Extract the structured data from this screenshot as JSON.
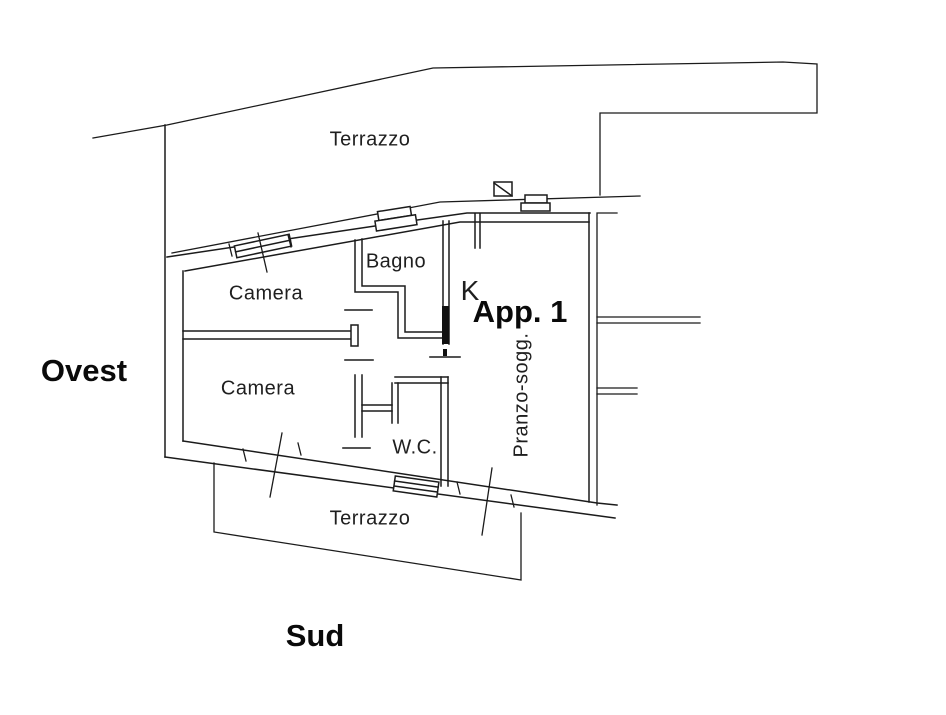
{
  "plan": {
    "type": "floor-plan",
    "labels": {
      "terrazzo_top": "Terrazzo",
      "camera_upper": "Camera",
      "bagno": "Bagno",
      "k": "K",
      "app": "App. 1",
      "pranzo": "Pranzo-sogg.",
      "camera_lower": "Camera",
      "wc": "W.C.",
      "terrazzo_bottom": "Terrazzo",
      "ovest": "Ovest",
      "sud": "Sud"
    },
    "colors": {
      "line": "#1b1b1b",
      "background": "#ffffff",
      "plan_text": "#1f1f1f",
      "annotation_text": "#0a0a0a"
    }
  }
}
